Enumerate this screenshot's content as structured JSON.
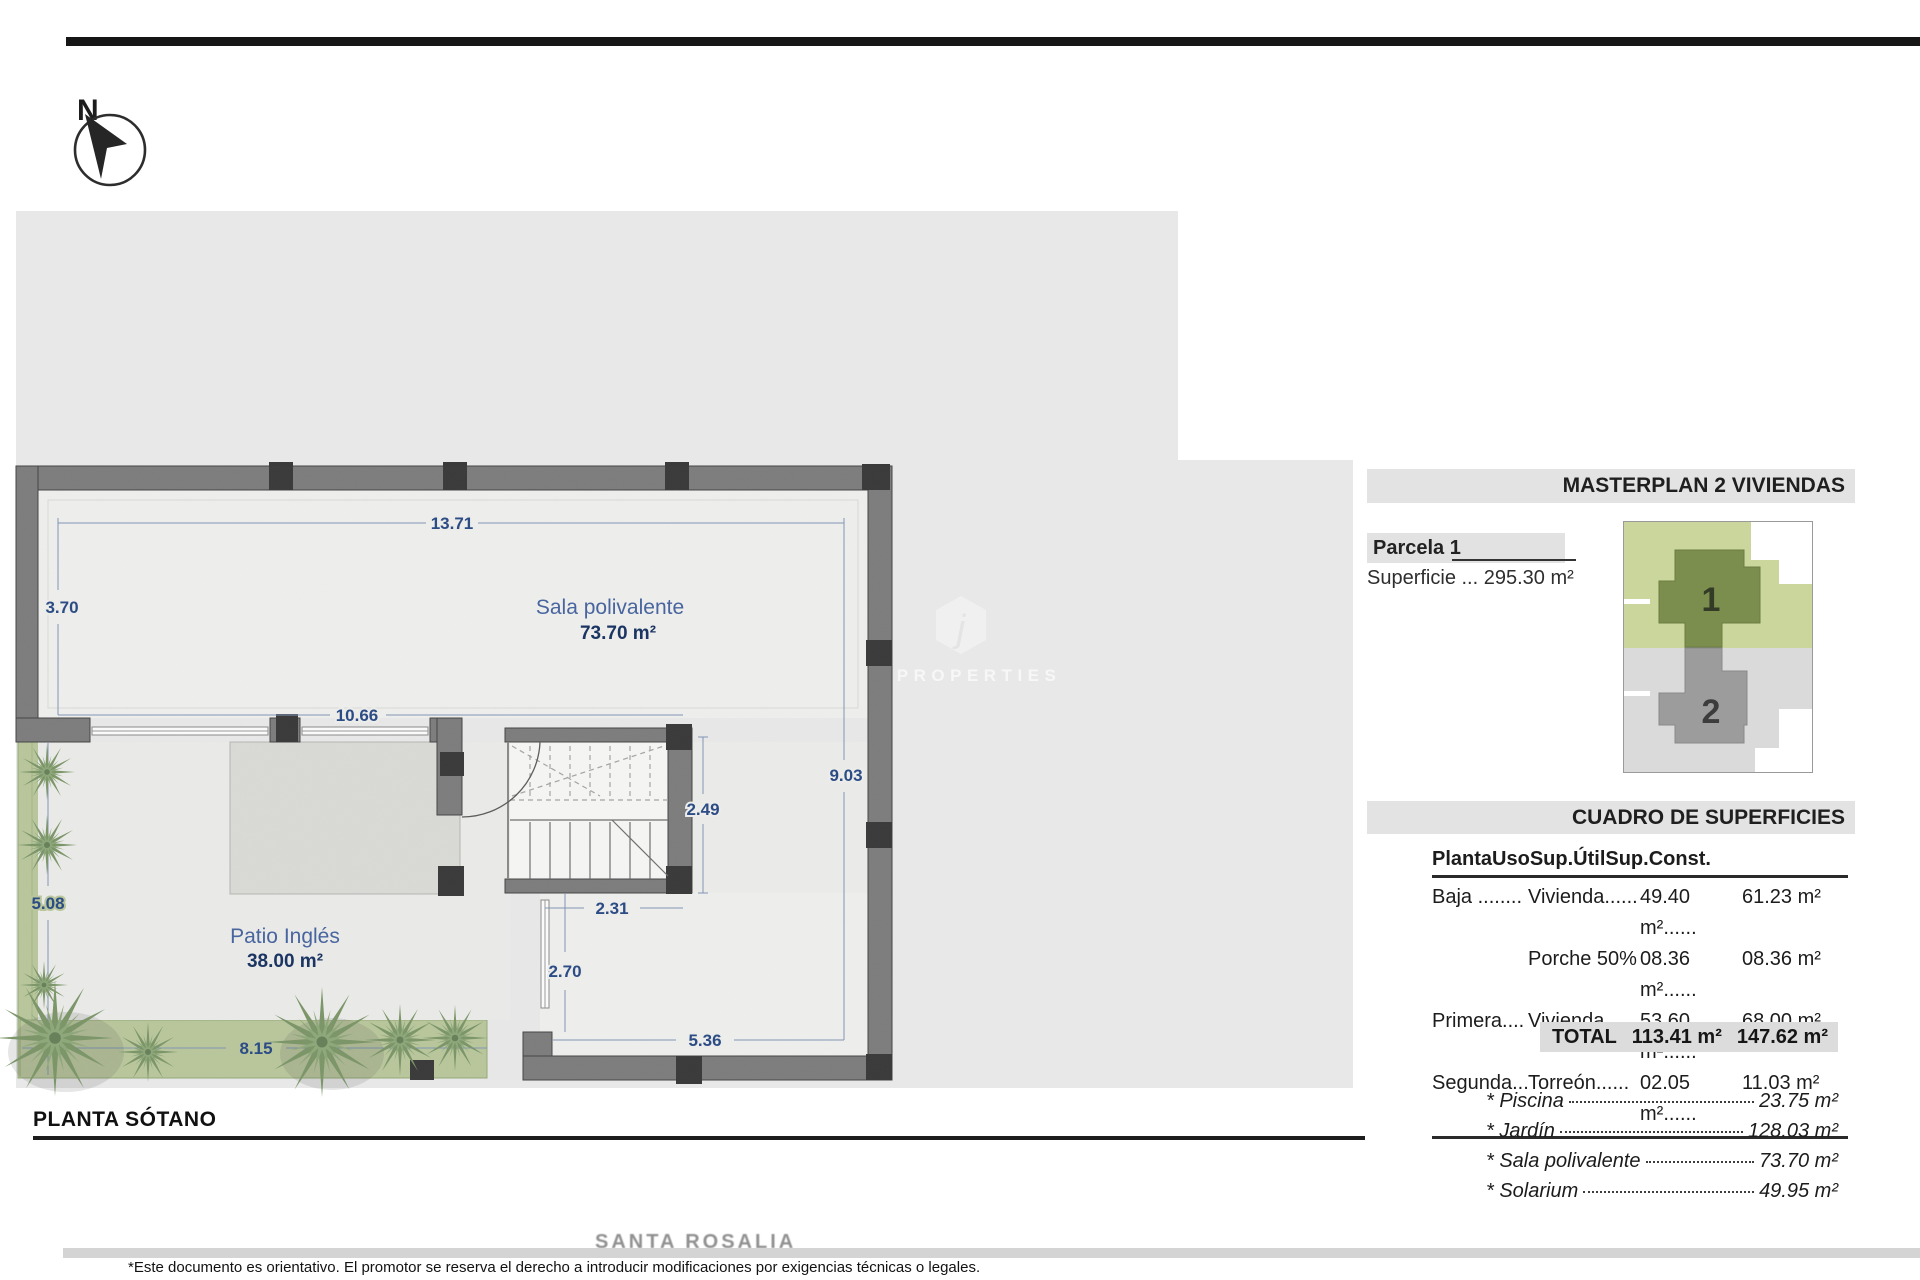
{
  "compass": {
    "label": "N"
  },
  "plan": {
    "title": "PLANTA SÓTANO",
    "rooms": {
      "sala": {
        "name": "Sala polivalente",
        "area": "73.70 m²"
      },
      "patio": {
        "name": "Patio Inglés",
        "area": "38.00 m²"
      }
    },
    "dims": {
      "top": "13.71",
      "left_upper": "3.70",
      "mid": "10.66",
      "right": "9.03",
      "stair": "2.49",
      "under_stair": "2.31",
      "left_lower": "5.08",
      "garden": "8.15",
      "porch_v": "2.70",
      "porch_h": "5.36"
    }
  },
  "watermark": {
    "logo": "j",
    "name": "JJ PROPERTIES"
  },
  "panel": {
    "masterplan": {
      "title": "MASTERPLAN 2 VIVIENDAS",
      "parcela": "Parcela 1",
      "superficie": "Superficie ... 295.30 m²",
      "unit1": "1",
      "unit2": "2"
    },
    "cuadro": {
      "title": "CUADRO DE SUPERFICIES",
      "headers": [
        "Planta",
        "Uso",
        "Sup.Útil",
        "Sup.Const."
      ],
      "rows": [
        [
          "Baja ........",
          "Vivienda......",
          "49.40 m²......",
          "61.23 m²"
        ],
        [
          "",
          "Porche 50%",
          "08.36 m²......",
          "08.36 m²"
        ],
        [
          "Primera....",
          "Vivienda......",
          "53.60 m²......",
          "68.00 m²"
        ],
        [
          "Segunda...",
          "Torreón......",
          "02.05 m²......",
          "11.03 m²"
        ]
      ],
      "total_label": "TOTAL",
      "total_util": "113.41 m²",
      "total_const": "147.62 m²"
    },
    "extras": [
      {
        "label": "* Piscina",
        "value": "23.75 m²"
      },
      {
        "label": "* Jardín",
        "value": "128.03 m²"
      },
      {
        "label": "* Sala polivalente",
        "value": "73.70 m²"
      },
      {
        "label": "* Solarium",
        "value": "49.95 m²"
      }
    ]
  },
  "footer": {
    "ghost": "SANTA ROSALIA",
    "disclaimer": "*Este documento es orientativo. El promotor se reserva el derecho a introducir modificaciones por exigencias técnicas o legales."
  }
}
